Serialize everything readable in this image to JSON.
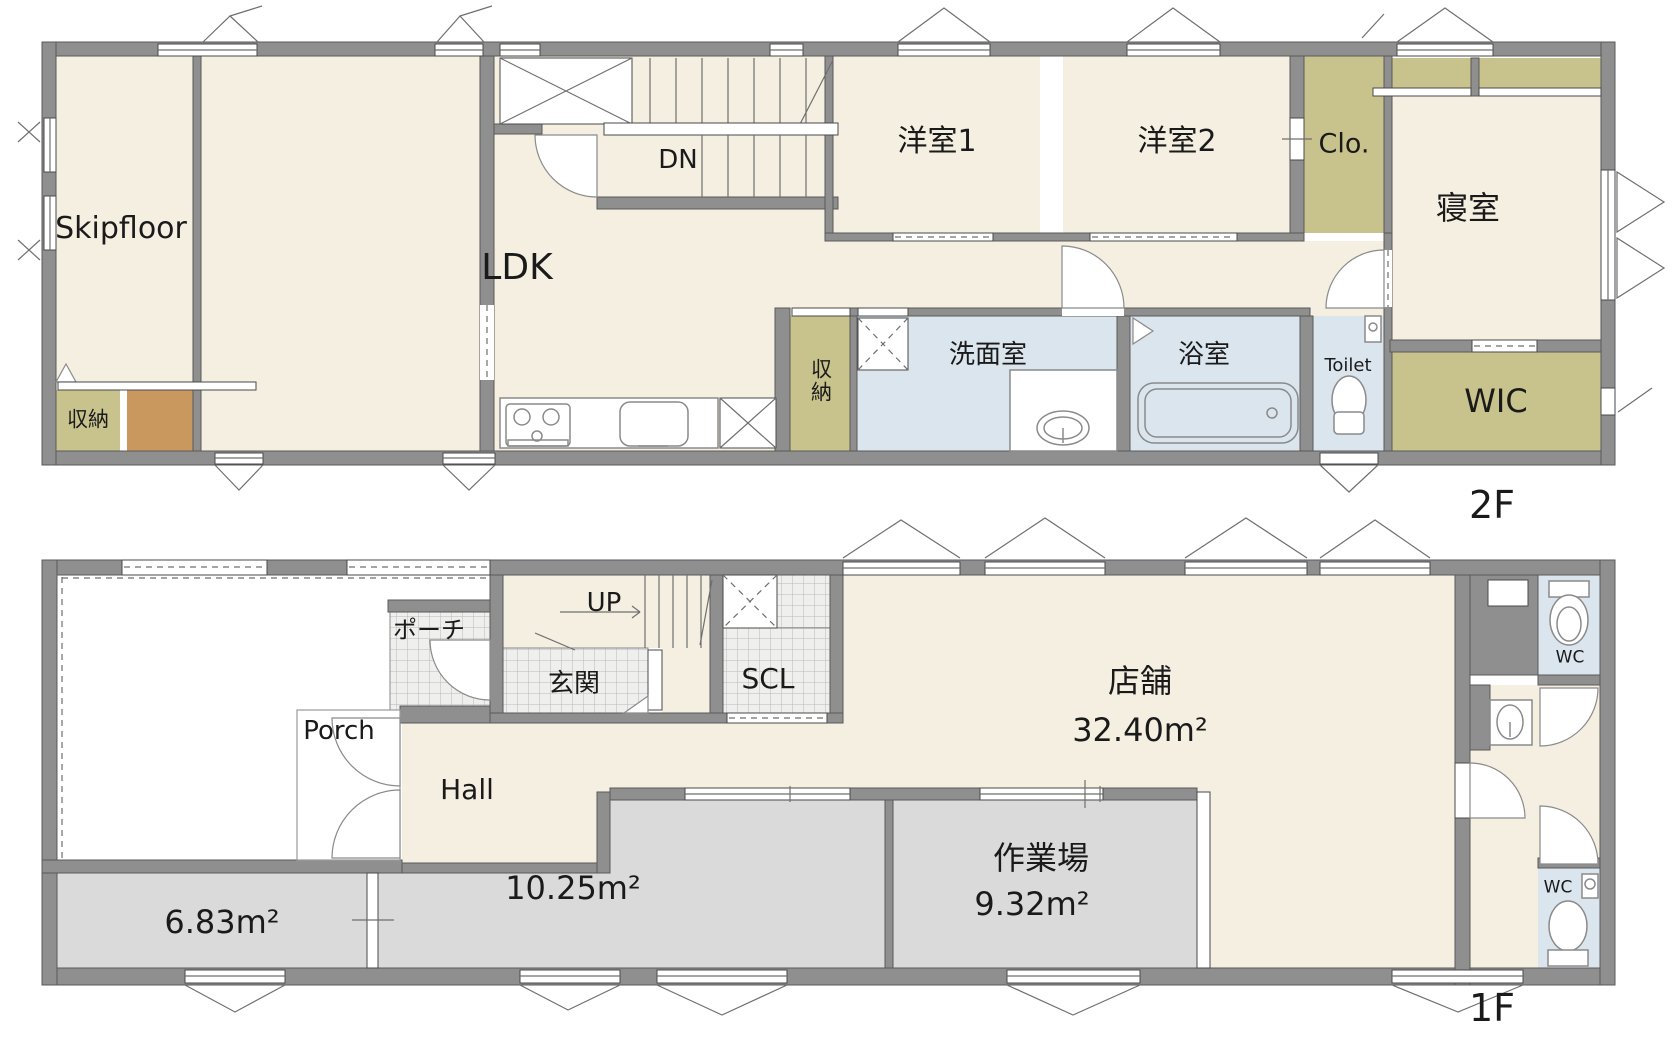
{
  "document_type": "floor-plan",
  "colors": {
    "wall": "#8f8f8f",
    "room_cream": "#f4efe1",
    "closet_olive": "#c8c38d",
    "wet_area_blue": "#dbe5ee",
    "work_area_gray": "#dadada",
    "accent_brown": "#c9985f",
    "background": "#ffffff"
  },
  "floor2": {
    "tag": "2F",
    "skipfloor": "Skipfloor",
    "storage_a": "収納",
    "ldk": "LDK",
    "dn": "DN",
    "room1": "洋室1",
    "room2": "洋室2",
    "closet": "Clo.",
    "bedroom": "寝室",
    "storage_b": "収納",
    "washroom": "洗面室",
    "bathroom": "浴室",
    "toilet": "Toilet",
    "wic": "WIC"
  },
  "floor1": {
    "tag": "1F",
    "porch_jp": "ポーチ",
    "up": "UP",
    "entrance": "玄関",
    "scl": "SCL",
    "shop_name": "店舗",
    "shop_area": "32.40m²",
    "porch_en": "Porch",
    "hall": "Hall",
    "area_a": "6.83m²",
    "area_b": "10.25m²",
    "workshop_name": "作業場",
    "workshop_area": "9.32m²",
    "wc1": "WC",
    "wc2": "WC"
  }
}
